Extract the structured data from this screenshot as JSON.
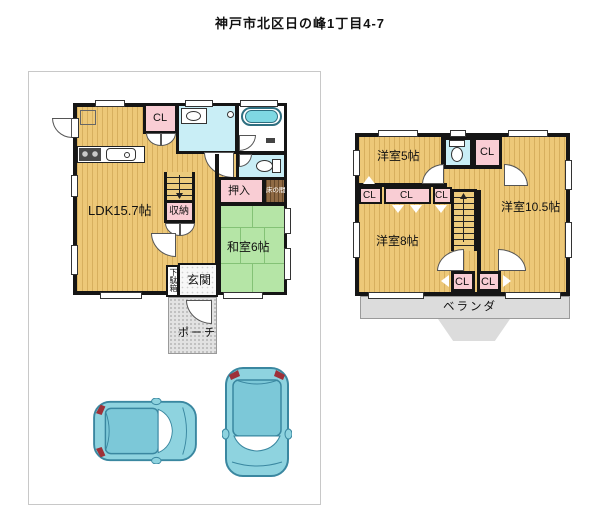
{
  "title": "神戸市北区日の峰1丁目4-7",
  "floor1": {
    "rooms": {
      "ldk": "LDK15.7帖",
      "closet": "CL",
      "washitsu": "和室6帖",
      "oshiire": "押入",
      "tokonoma": "床の間",
      "shuno": "収納",
      "getabako": "下駄箱",
      "genkan": "玄関",
      "porch": "ポーチ"
    }
  },
  "floor2": {
    "rooms": {
      "west5": "洋室5帖",
      "west8": "洋室8帖",
      "west10_5": "洋室10.5帖",
      "cl_top": "CL",
      "cl_left": "CL",
      "cl_mid": "CL",
      "cl_right": "CL",
      "cl_bottom1": "CL",
      "cl_bottom2": "CL",
      "veranda": "ベランダ"
    }
  },
  "colors": {
    "flooring_tan": "#edc878",
    "tatami_green": "#b5e5a6",
    "closet_pink": "#f9cdd4",
    "sanitary_cyan": "#c9eef6",
    "tokonoma_brown": "#8f6a44",
    "outdoor_gray": "#dcdcdc",
    "wall_black": "#151515",
    "car_teal": "#8ed3df"
  }
}
